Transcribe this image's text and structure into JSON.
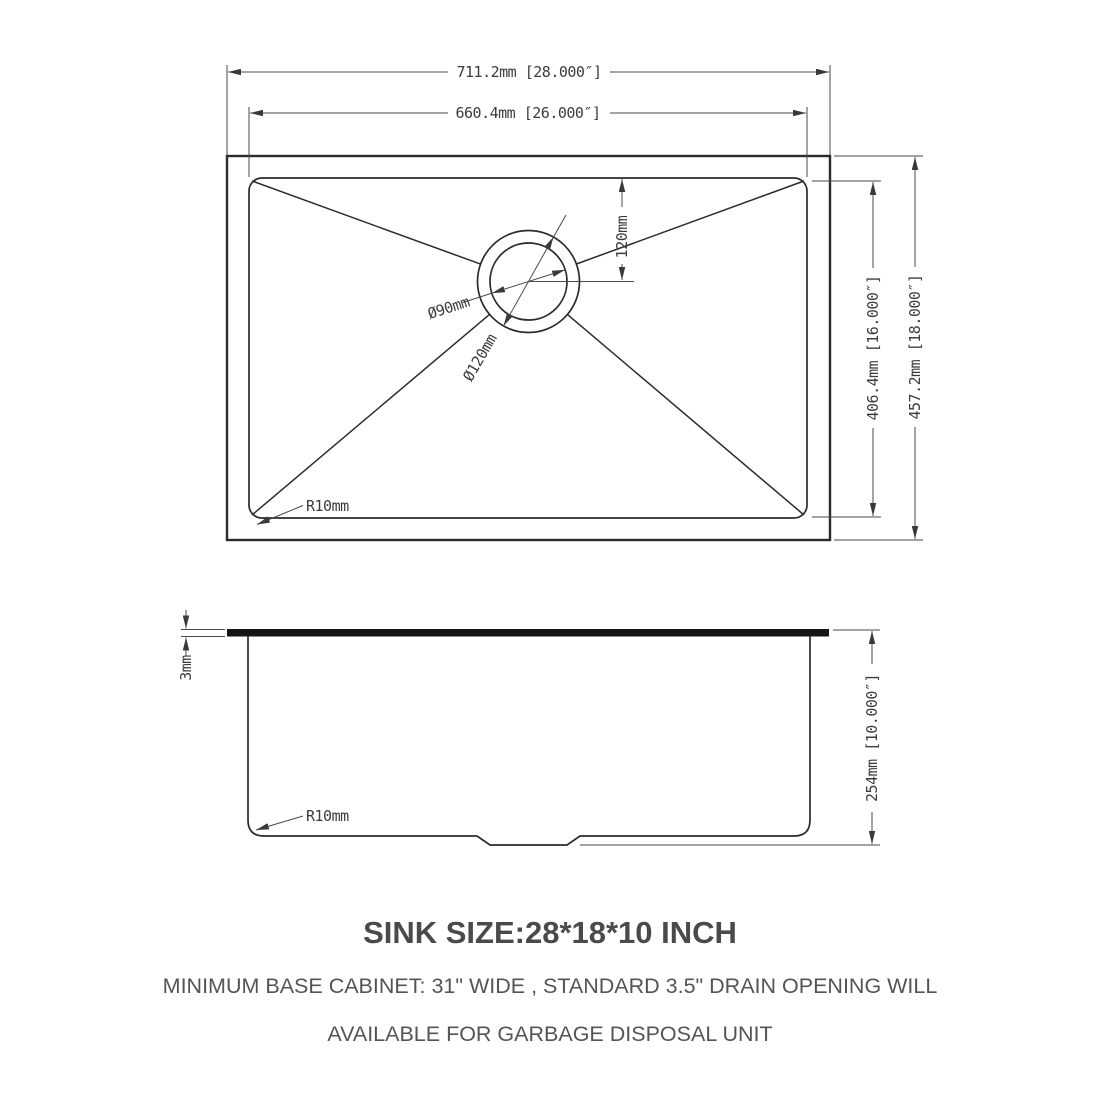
{
  "dims": {
    "outer_width": "711.2mm [28.000″]",
    "inner_width": "660.4mm [26.000″]",
    "inner_height": "406.4mm [16.000″]",
    "outer_height": "457.2mm [18.000″]",
    "drain_offset": "120mm",
    "drain_inner_dia": "Ø90mm",
    "drain_outer_dia": "Ø120mm",
    "corner_radius_top": "R10mm",
    "rim_thickness": "3mm",
    "depth": "254mm [10.000″]",
    "corner_radius_side": "R10mm"
  },
  "notes": {
    "title": "SINK SIZE:28*18*10 INCH",
    "line1": "MINIMUM BASE CABINET: 31\" WIDE , STANDARD 3.5\" DRAIN OPENING WILL",
    "line2": "AVAILABLE FOR GARBAGE DISPOSAL UNIT"
  },
  "colors": {
    "object_line": "#2b2b2b",
    "dim_line": "#4a4a4a",
    "text": "#3c3c3c",
    "background": "#ffffff"
  }
}
